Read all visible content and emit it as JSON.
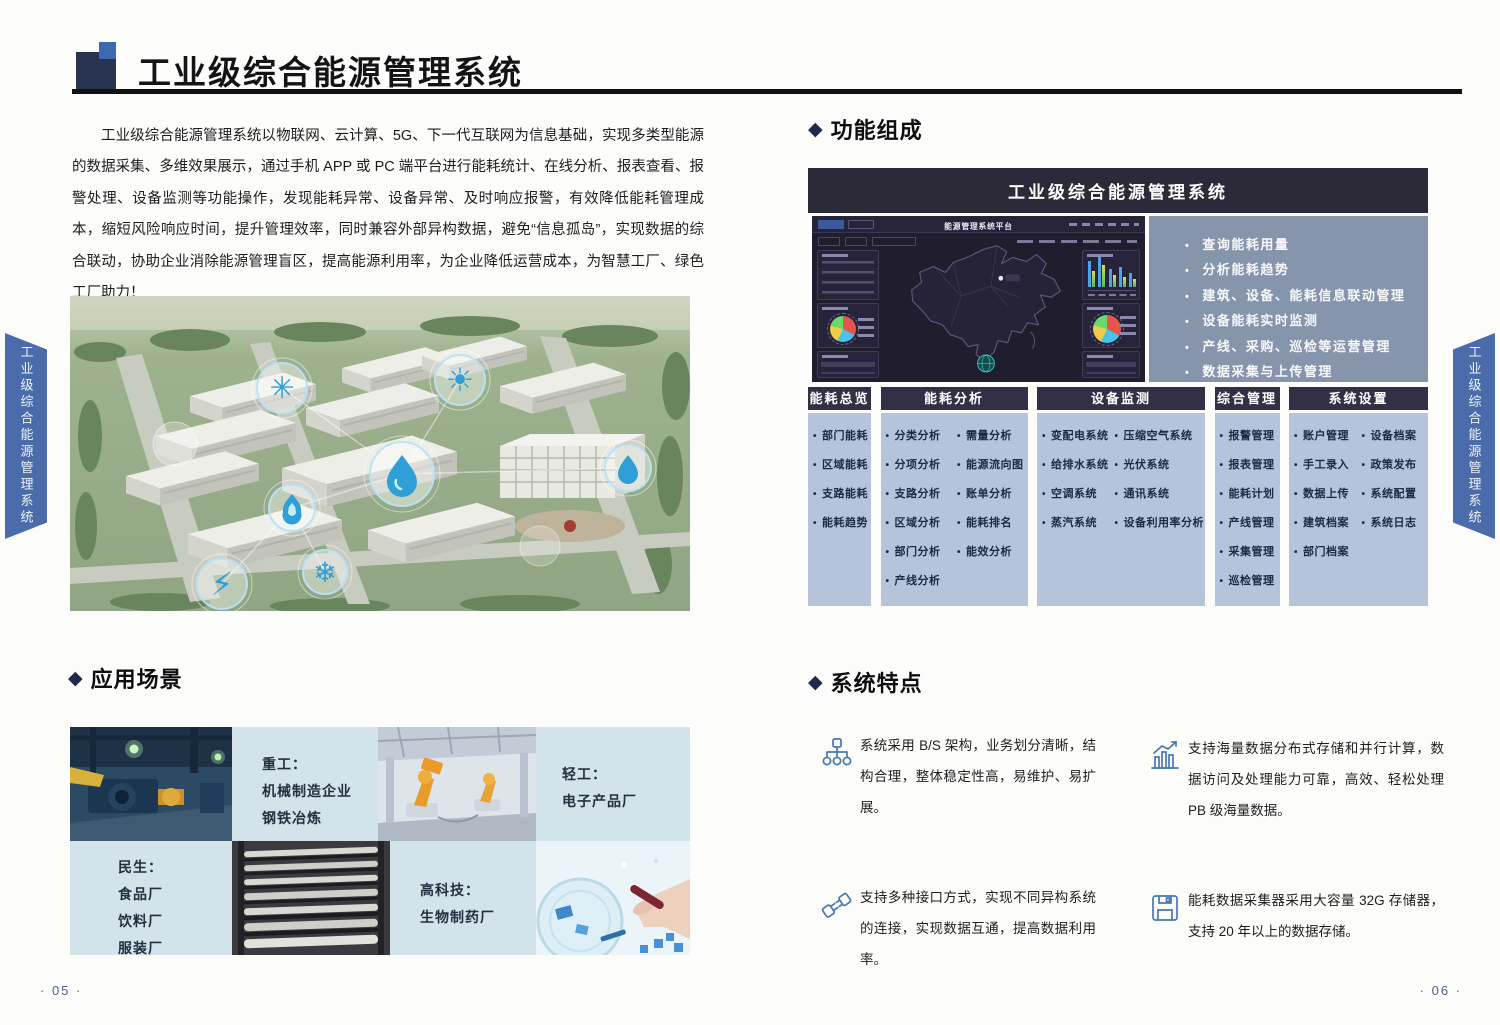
{
  "page": {
    "left_page_number": "· 05 ·",
    "right_page_number": "· 06 ·",
    "side_tab": "工业级综合能源管理系统"
  },
  "section_marker": "◆",
  "header": {
    "title": "工业级综合能源管理系统"
  },
  "intro": {
    "text": "工业级综合能源管理系统以物联网、云计算、5G、下一代互联网为信息基础，实现多类型能源的数据采集、多维效果展示，通过手机 APP 或 PC 端平台进行能耗统计、在线分析、报表查看、报警处理、设备监测等功能操作，发现能耗异常、设备异常、及时响应报警，有效降低能耗管理成本，缩短风险响应时间，提升管理效率，同时兼容外部异构数据，避免“信息孤岛”，实现数据的综合联动，协助企业消除能源管理盲区，提高能源利用率，为企业降低运营成本，为智慧工厂、绿色工厂助力！"
  },
  "sections": {
    "functions": {
      "title": "功能组成"
    },
    "application": {
      "title": "应用场景"
    },
    "features": {
      "title": "系统特点"
    }
  },
  "function_diagram": {
    "banner_title": "工业级综合能源管理系统",
    "dashboard_title": "能源管理系统平台",
    "bullets": [
      "查询能耗用量",
      "分析能耗趋势",
      "建筑、设备、能耗信息联动管理",
      "设备能耗实时监测",
      "产线、采购、巡检等运营管理",
      "数据采集与上传管理"
    ],
    "columns": [
      {
        "header": "能耗总览",
        "lists": [
          [
            "部门能耗",
            "区域能耗",
            "支路能耗",
            "能耗趋势"
          ]
        ]
      },
      {
        "header": "能耗分析",
        "lists": [
          [
            "分类分析",
            "分项分析",
            "支路分析",
            "区域分析",
            "部门分析",
            "产线分析"
          ],
          [
            "需量分析",
            "能源流向图",
            "账单分析",
            "能耗排名",
            "能效分析"
          ]
        ]
      },
      {
        "header": "设备监测",
        "lists": [
          [
            "变配电系统",
            "给排水系统",
            "空调系统",
            "蒸汽系统"
          ],
          [
            "压缩空气系统",
            "光伏系统",
            "通讯系统",
            "设备利用率分析"
          ]
        ]
      },
      {
        "header": "综合管理",
        "lists": [
          [
            "报警管理",
            "报表管理",
            "能耗计划",
            "产线管理",
            "采集管理",
            "巡检管理"
          ]
        ]
      },
      {
        "header": "系统设置",
        "lists": [
          [
            "账户管理",
            "手工录入",
            "数据上传",
            "建筑档案",
            "部门档案"
          ],
          [
            "设备档案",
            "政策发布",
            "系统配置",
            "系统日志"
          ]
        ]
      }
    ]
  },
  "scenarios": [
    {
      "label": "重工：",
      "lines": [
        "机械制造企业",
        "钢铁冶炼"
      ]
    },
    {
      "label": "轻工：",
      "lines": [
        "电子产品厂"
      ]
    },
    {
      "label": "民生：",
      "lines": [
        "食品厂",
        "饮料厂",
        "服装厂"
      ]
    },
    {
      "label": "高科技：",
      "lines": [
        "生物制药厂"
      ]
    }
  ],
  "features": [
    {
      "icon": "hierarchy-icon",
      "text": "系统采用 B/S 架构，业务划分清晰，结构合理，整体稳定性高，易维护、易扩展。"
    },
    {
      "icon": "bar-chart-icon",
      "text": "支持海量数据分布式存储和并行计算，数据访问及处理能力可靠，高效、轻松处理 PB 级海量数据。"
    },
    {
      "icon": "plug-icon",
      "text": "支持多种接口方式，实现不同异构系统的连接，实现数据互通，提高数据利用率。"
    },
    {
      "icon": "floppy-disk-icon",
      "text": "能耗数据采集器采用大容量 32G 存储器，支持 20 年以上的数据存储。"
    }
  ],
  "colors": {
    "accent_blue": "#4b6cab",
    "panel_slate": "#8694ac",
    "table_body_blue": "#b5c4db",
    "header_dark": "#2c2a39",
    "table_header_dark": "#322f47",
    "scene_cell_blue": "#d2e3ea",
    "icon_stroke_blue": "#4678b2"
  }
}
